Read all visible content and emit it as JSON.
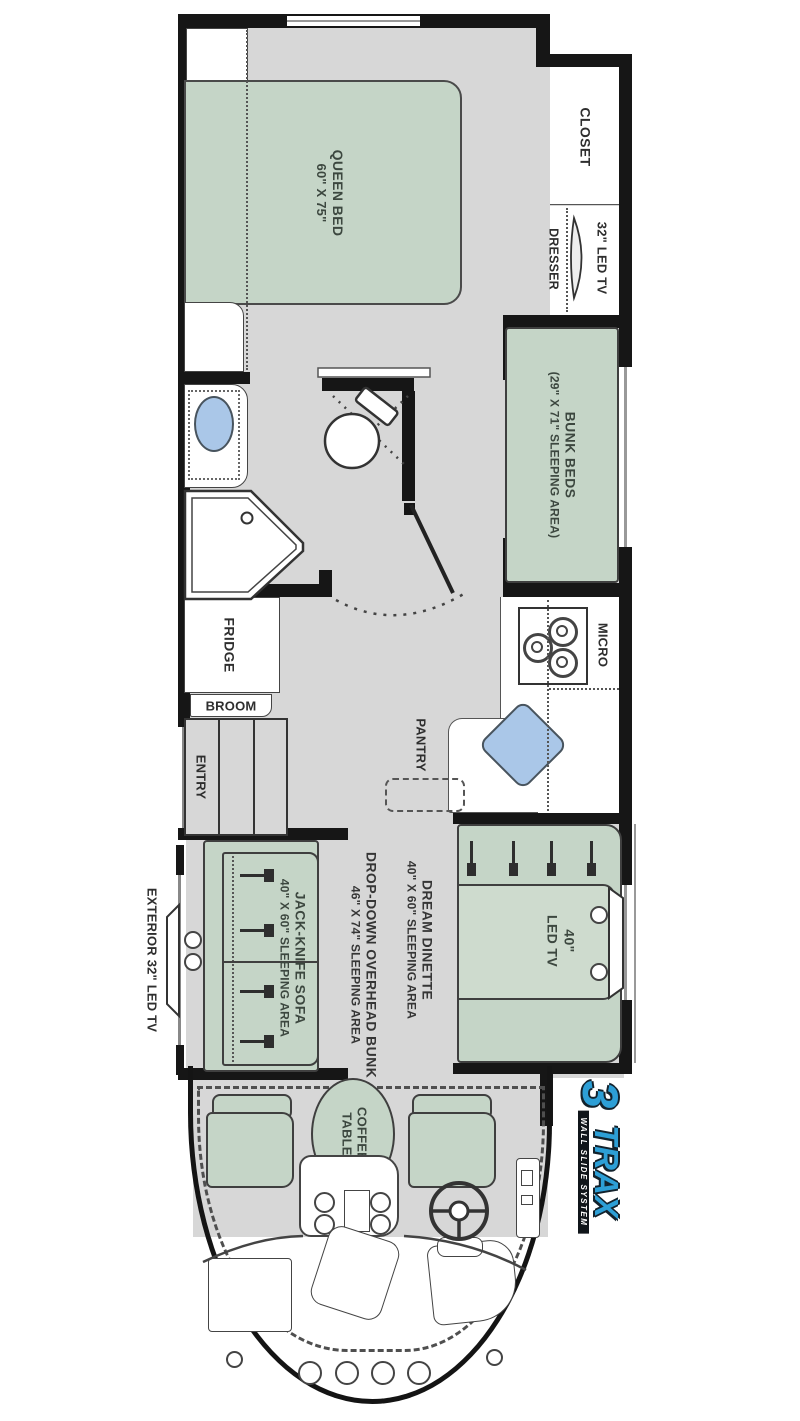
{
  "plan": {
    "type": "rv-floorplan",
    "colors": {
      "wall": "#161616",
      "floor": "#d7d7d7",
      "furniture_green": "#c5d5c7",
      "water_blue": "#aac7e8",
      "logo_blue": "#2d9fd6"
    },
    "bedroom": {
      "queen_bed": {
        "name": "QUEEN BED",
        "size": "60\" X 75\""
      },
      "closet": "CLOSET",
      "dresser": "DRESSER",
      "tv": "32\" LED TV"
    },
    "bunk_room": {
      "bunk_beds": {
        "name": "BUNK BEDS",
        "size": "(29\" X 71\" SLEEPING AREA)"
      }
    },
    "bathroom": {
      "shower": {
        "name": "SHOWER",
        "size": "32\" X 32\""
      }
    },
    "kitchen": {
      "fridge": "FRIDGE",
      "broom": "BROOM",
      "entry": "ENTRY",
      "micro": "MICRO",
      "pantry": "PANTRY"
    },
    "living": {
      "dinette": {
        "name": "DREAM DINETTE",
        "size": "40\" X 60\" SLEEPING AREA"
      },
      "overhead_bunk": {
        "name": "DROP-DOWN OVERHEAD BUNK",
        "size": "46\" X 74\" SLEEPING AREA"
      },
      "sofa": {
        "name": "JACK-KNIFE SOFA",
        "size": "40\" X 60\" SLEEPING AREA"
      },
      "tv": {
        "line1": "40\"",
        "line2": "LED TV"
      },
      "exterior_tv": "EXTERIOR 32\" LED TV"
    },
    "cab": {
      "coffee_table": {
        "line1": "COFFEE",
        "line2": "TABLE"
      }
    },
    "logo": {
      "number": "3",
      "name": "TRAX",
      "tagline": "WALL SLIDE SYSTEM"
    }
  }
}
